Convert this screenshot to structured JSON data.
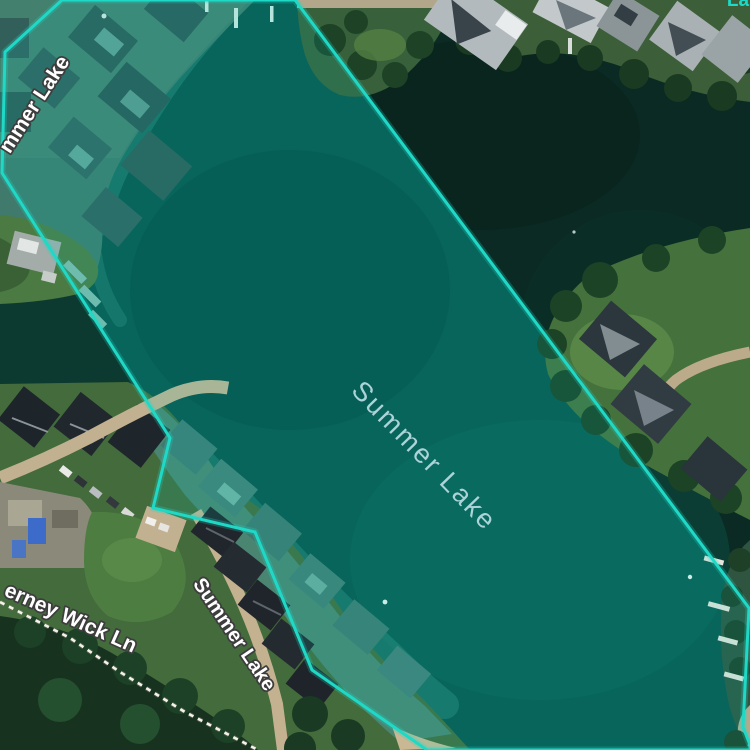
{
  "labels": {
    "lake": "Summer Lake",
    "street_summer_lake": "Summer Lake",
    "cerney_wick_lane": "erney Wick Ln",
    "summer_lake_partial": "mmer Lake",
    "corner_label_fragment": "La"
  },
  "selection": {
    "feature_name": "Summer Lake",
    "polygon_points": "295,0 749,608 743,727 750,745 750,750 427,750 312,670 255,532 153,508 170,438 2,173 5,52 62,0",
    "stroke_color": "#1fd9c6",
    "fill_color": "rgba(0,219,198,0.13)",
    "lake_water_color": "#0a544b"
  },
  "colors": {
    "water_outside": "#0d3a30",
    "water_dark": "#0a2a23",
    "label_lake_text": "#b9dce2",
    "road_label_text": "#ffffff",
    "road_label_outline": "#3d3d3d",
    "footpath_dash": "#f5f2ea"
  }
}
